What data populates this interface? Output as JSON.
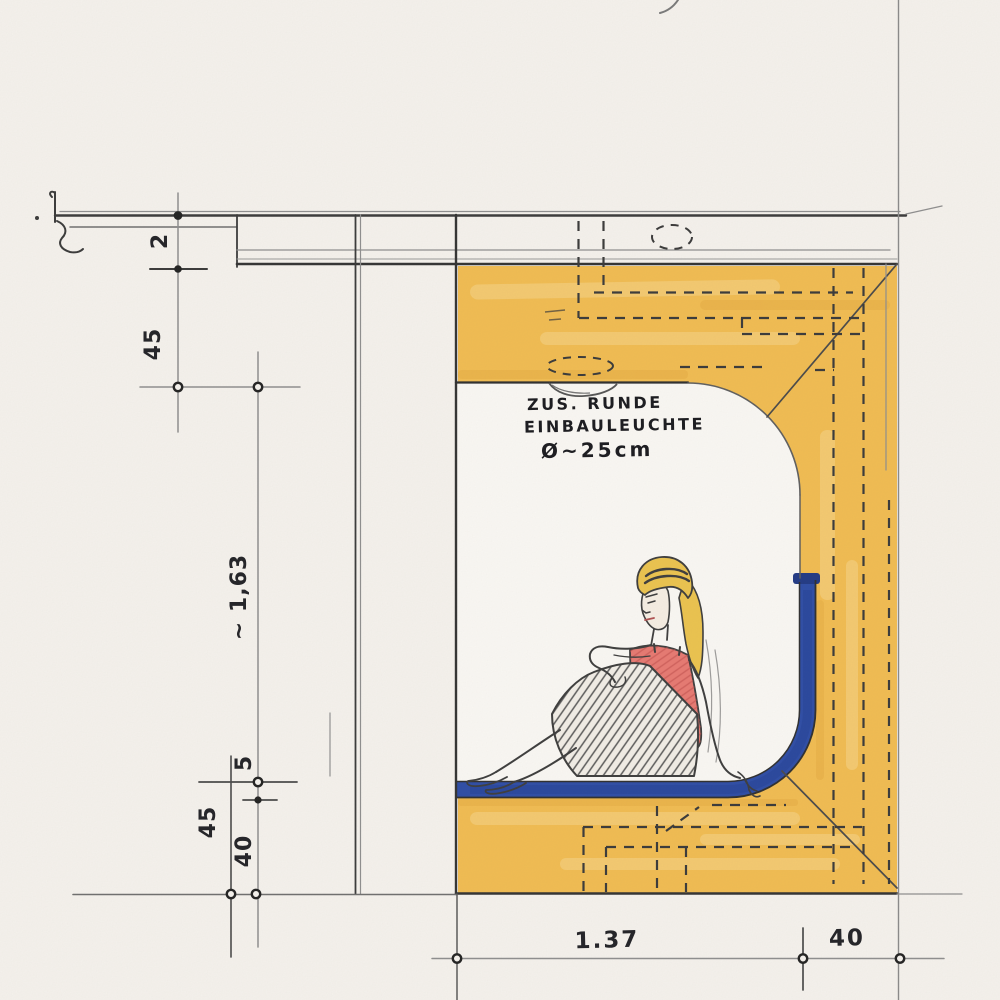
{
  "sketch": {
    "annotation": {
      "line1": "ZUS. RUNDE",
      "line2": "EINBAULEUCHTE",
      "line3": "Ø~25cm"
    },
    "dimensions": {
      "ceiling_offset": "2",
      "soffit_height": "45",
      "opening_height": "~ 1,63",
      "seat_thickness": "5",
      "seat_height": "45",
      "under_seat": "40",
      "niche_width": "1.37",
      "bench_depth": "40"
    },
    "colors": {
      "paper": "#f6f3ee",
      "wood": "#f2bd52",
      "wood_light": "#f8d88e",
      "wood_shade": "#e2a63c",
      "cushion": "#2e4da6",
      "cushion_dark": "#223a85",
      "top_red": "#e87a72",
      "hair": "#ecc44f",
      "pencil": "#3d3d3d",
      "construction": "#8f8f8f",
      "ink": "#262626"
    }
  }
}
